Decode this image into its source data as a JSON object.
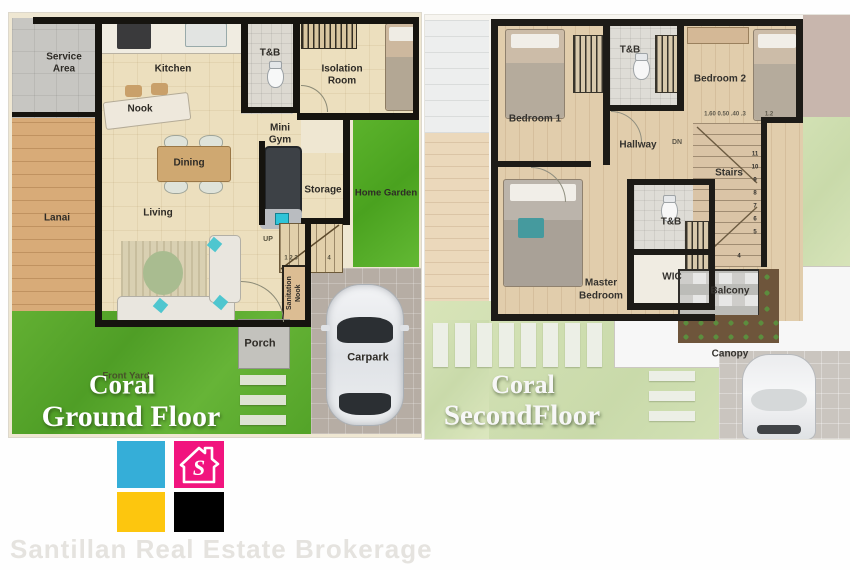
{
  "left_plan": {
    "title": {
      "line1": "Coral",
      "line2": "Ground Floor"
    },
    "rooms": {
      "service_area": "Service Area",
      "kitchen": "Kitchen",
      "nook": "Nook",
      "tb": "T&B",
      "isolation_room": "Isolation Room",
      "mini_gym": "Mini Gym",
      "dining": "Dining",
      "storage": "Storage",
      "home_garden": "Home Garden",
      "lanai": "Lanai",
      "living": "Living",
      "sanitation_nook": "Sanitation Nook",
      "porch": "Porch",
      "front_yard": "Front Yard",
      "carpark": "Carpark"
    },
    "stair_text": {
      "up": "UP",
      "marks_low": "1 2 3",
      "mark_end": "4"
    }
  },
  "right_plan": {
    "title": {
      "line1": "Coral",
      "line2": "SecondFloor"
    },
    "rooms": {
      "bedroom1": "Bedroom 1",
      "tb_upper": "T&B",
      "bedroom2": "Bedroom 2",
      "hallway": "Hallway",
      "stairs": "Stairs",
      "tb_lower": "T&B",
      "wic": "WIC",
      "master_line1": "Master",
      "master_line2": "Bedroom",
      "balcony": "Balcony",
      "canopy": "Canopy"
    },
    "stair_text": {
      "dn": "DN",
      "dims": "1.60 0.50 .40 .3",
      "dims2": "1.2"
    },
    "step_numbers": [
      "11",
      "10",
      "9",
      "8",
      "7",
      "6",
      "5",
      "4"
    ]
  },
  "branding": {
    "company": "Santillan Real Estate Brokerage",
    "logo_letter": "S",
    "colors": {
      "cyan": "#35aed8",
      "magenta": "#f1147e",
      "yellow": "#fdc60e",
      "black": "#000000",
      "grass_green": "#58ab2c",
      "wall_black": "#16140f",
      "title_white": "#ffffff"
    }
  }
}
